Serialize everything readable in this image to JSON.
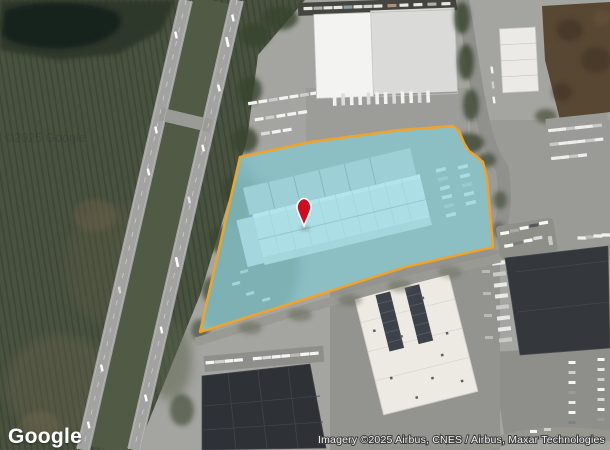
{
  "map": {
    "logo": "Google",
    "attribution": "Imagery ©2025 Airbus, CNES / Airbus, Maxar Technologies",
    "watermark": "©2025 Google"
  },
  "parcel": {
    "points": "200,332 240,157 310,142 400,130 453,126 459,131 464,143 469,151 477,157 483,162 487,179 493,247 405,267 305,299",
    "fill_color": "#5ecfdf",
    "fill_opacity": "0.45",
    "border_color": "#f0a32b",
    "border_width": "2.5"
  },
  "pin": {
    "transform": "translate(304,212)",
    "fill_color": "#ce0e20",
    "outline_color": "#ffffff"
  }
}
